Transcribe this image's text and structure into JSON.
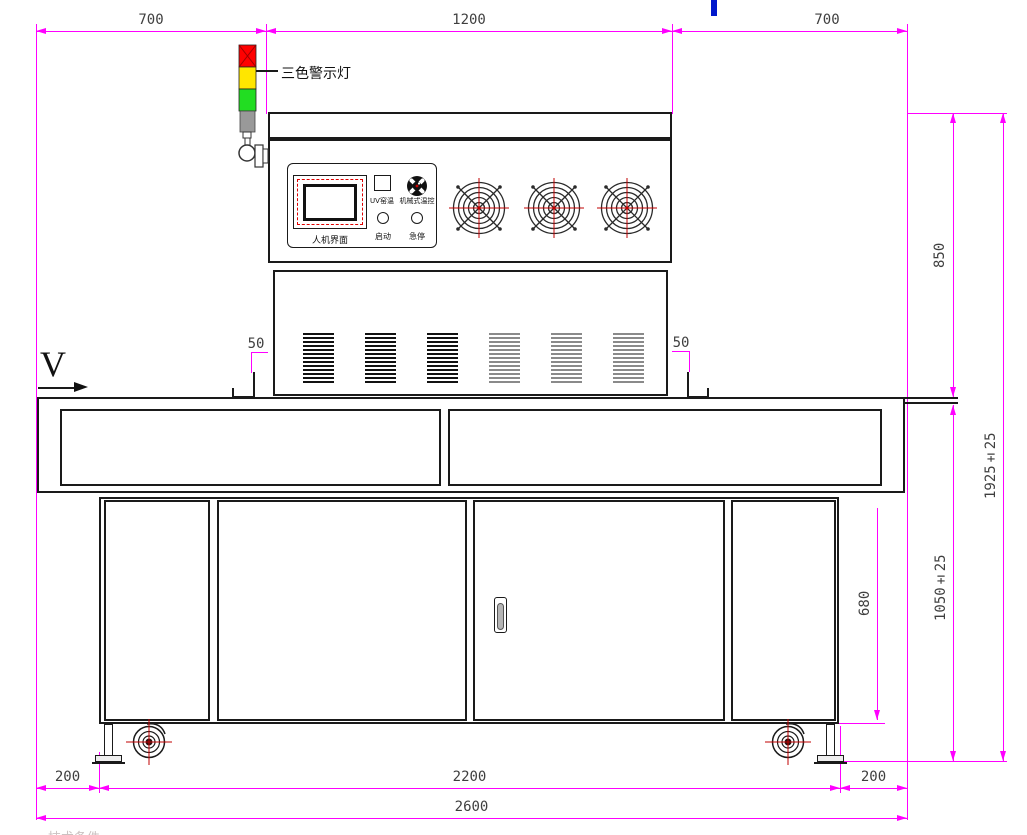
{
  "annotations": {
    "tower_light_label": "三色警示灯",
    "direction_label": "V",
    "footer_note": "技术条件"
  },
  "control_panel": {
    "screen_label": "人机界面",
    "uv_button_label": "UV窑温",
    "knob_label": "机械式温控",
    "start_label": "启动",
    "estop_label": "急停"
  },
  "dimensions": {
    "top_left": "700",
    "top_center": "1200",
    "top_right": "700",
    "offset_left": "50",
    "offset_right": "50",
    "height_head": "850",
    "height_total": "1925±25",
    "height_table": "1050±25",
    "height_cabinet": "680",
    "bottom_left": "200",
    "bottom_center": "2200",
    "bottom_right": "200",
    "bottom_total": "2600"
  },
  "colors": {
    "dimension_line": "#ff00ff",
    "dimension_text": "#3f3f3f",
    "outline": "#1a1a1a",
    "accent_red": "#cc0000",
    "tower_red": "#ff0000",
    "tower_yellow": "#ffe600",
    "tower_green": "#22dd22",
    "tower_gray": "#999999",
    "blue_mark": "#0018cc"
  }
}
